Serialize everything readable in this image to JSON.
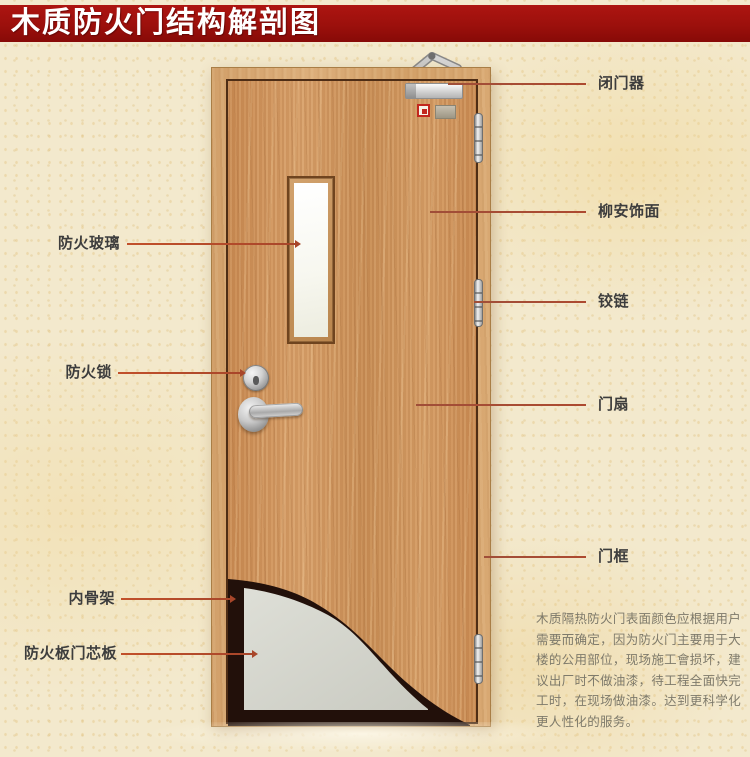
{
  "title": "木质防火门结构解剖图",
  "labels": {
    "left": [
      {
        "text": "防火玻璃"
      },
      {
        "text": "防火锁"
      },
      {
        "text": "内骨架"
      },
      {
        "text": "防火板门芯板"
      }
    ],
    "right": [
      {
        "text": "闭门器"
      },
      {
        "text": "柳安饰面"
      },
      {
        "text": "铰链"
      },
      {
        "text": "门扇"
      },
      {
        "text": "门框"
      }
    ]
  },
  "description": "木质隔热防火门表面颜色应根据用户需要而确定，因为防火门主要用于大楼的公用部位，现场施工會损坏，建议出厂时不做油漆，待工程全面快完工时，在现场做油漆。达到更科学化更人性化的服务。",
  "colors": {
    "banner": "#9c100c",
    "leader_line": "#ad4a30",
    "door_wood": "#cf9760",
    "frame_wood": "#d7a470",
    "core_panel": "#d6d6ce",
    "inner_skeleton": "#22100a",
    "background": "#f3e9cd"
  }
}
